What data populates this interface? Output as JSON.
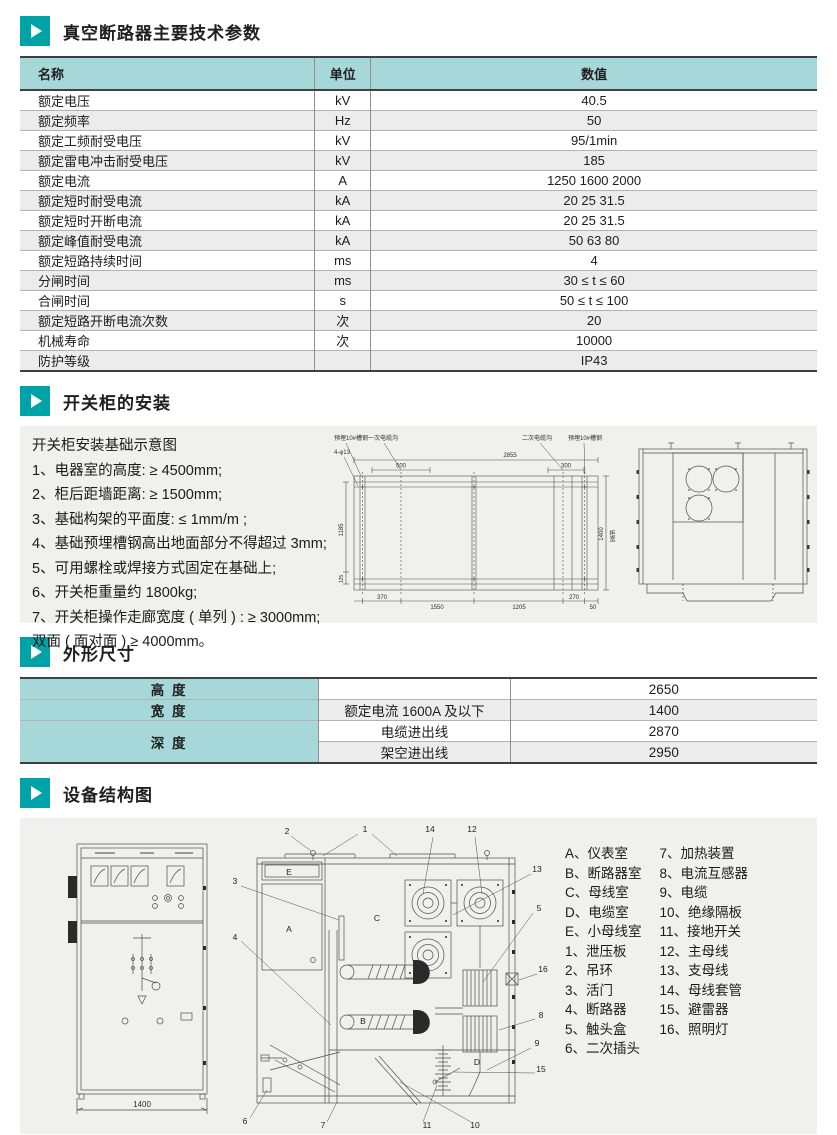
{
  "colors": {
    "accent": "#00a3a8",
    "table_header_bg": "#a6d8da",
    "alt_row_bg": "#ececec",
    "panel_bg": "#f0f0ee"
  },
  "sections": {
    "params": {
      "title": "真空断路器主要技术参数",
      "headers": [
        "名称",
        "单位",
        "数值"
      ],
      "rows": [
        [
          "额定电压",
          "kV",
          "40.5"
        ],
        [
          "额定频率",
          "Hz",
          "50"
        ],
        [
          "额定工频耐受电压",
          "kV",
          "95/1min"
        ],
        [
          "额定雷电冲击耐受电压",
          "kV",
          "185"
        ],
        [
          "额定电流",
          "A",
          "1250 1600 2000"
        ],
        [
          "额定短时耐受电流",
          "kA",
          "20 25 31.5"
        ],
        [
          "额定短时开断电流",
          "kA",
          "20 25 31.5"
        ],
        [
          "额定峰值耐受电流",
          "kA",
          "50 63 80"
        ],
        [
          "额定短路持续时间",
          "ms",
          "4"
        ],
        [
          "分闸时间",
          "ms",
          "30 ≤ t ≤ 60"
        ],
        [
          "合闸时间",
          "s",
          "50 ≤ t ≤ 100"
        ],
        [
          "额定短路开断电流次数",
          "次",
          "20"
        ],
        [
          "机械寿命",
          "次",
          "10000"
        ],
        [
          "防护等级",
          "",
          "IP43"
        ]
      ]
    },
    "installation": {
      "title": "开关柜的安装",
      "caption": "开关柜安装基础示意图",
      "notes": [
        "1、电器室的高度: ≥ 4500mm;",
        "2、柜后距墙距离: ≥ 1500mm;",
        "3、基础构架的平面度: ≤ 1mm/m ;",
        "4、基础预埋槽钢高出地面部分不得超过 3mm;",
        "5、可用螺栓或焊接方式固定在基础上;",
        "6、开关柜重量约 1800kg;",
        "7、开关柜操作走廊宽度 ( 单列 ) : ≥ 3000mm;",
        "双面 ( 面对面 ) ≥ 4000mm。"
      ],
      "plan": {
        "label_channel_left": "预埋10#槽钢",
        "label_primary_trench": "一次电缆沟",
        "label_secondary_trench": "二次电缆沟",
        "label_channel_right": "预埋10#槽钢",
        "label_holes": "4-φ13",
        "dim_total_width": "2855",
        "dim_primary": "500",
        "dim_secondary": "300",
        "dim_left_height": "1185",
        "dim_left_small": "125",
        "dim_b1": "370",
        "dim_b2": "1550",
        "dim_b3": "1205",
        "dim_b4": "270",
        "dim_b5": "50",
        "dim_right": "1400",
        "label_cabinet_width": "柜宽"
      }
    },
    "dimensions": {
      "title": "外形尺寸",
      "height_label": "高  度",
      "height_qualifier": "",
      "height_value": "2650",
      "width_label": "宽  度",
      "width_qualifier": "额定电流 1600A 及以下",
      "width_value": "1400",
      "depth_label": "深  度",
      "depth_cable_label": "电缆进出线",
      "depth_cable_value": "2870",
      "depth_overhead_label": "架空进出线",
      "depth_overhead_value": "2950"
    },
    "structure": {
      "title": "设备结构图",
      "front_dim": "1400",
      "legend_left": [
        "A、仪表室",
        "B、断路器室",
        "C、母线室",
        "D、电缆室",
        "E、小母线室",
        "1、泄压板",
        "2、吊环",
        "3、活门",
        "4、断路器",
        "5、触头盒",
        "6、二次插头"
      ],
      "legend_right": [
        "7、加热装置",
        "8、电流互感器",
        "9、电缆",
        "10、绝缘隔板",
        "11、接地开关",
        "12、主母线",
        "13、支母线",
        "14、母线套管",
        "15、避雷器",
        "16、照明灯"
      ],
      "callouts": [
        "1",
        "2",
        "3",
        "4",
        "5",
        "6",
        "7",
        "8",
        "9",
        "10",
        "11",
        "12",
        "13",
        "14",
        "15",
        "16"
      ],
      "compartments": [
        "A",
        "B",
        "C",
        "D",
        "E"
      ]
    }
  }
}
